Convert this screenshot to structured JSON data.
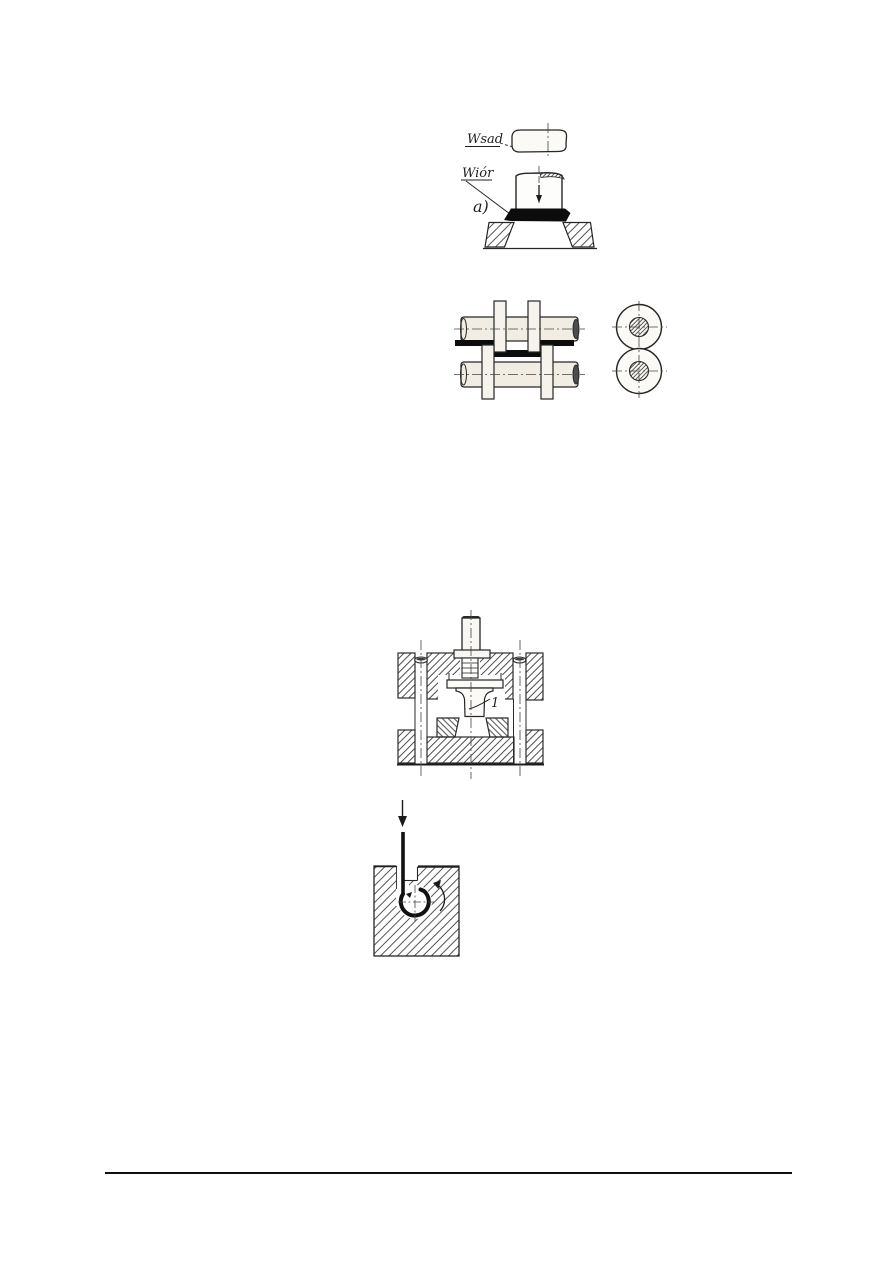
{
  "colors": {
    "paper": "#ffffff",
    "ink": "#262626",
    "chip_black": "#0c0c0c",
    "metal_fill": "#f1ede3",
    "footer_rule": "#101010"
  },
  "figure_upsetting": {
    "label_wsad": "Wsad",
    "label_wior": "Wiór",
    "label_variant": "a)"
  },
  "figure_die_set": {
    "punch_label": "1"
  }
}
